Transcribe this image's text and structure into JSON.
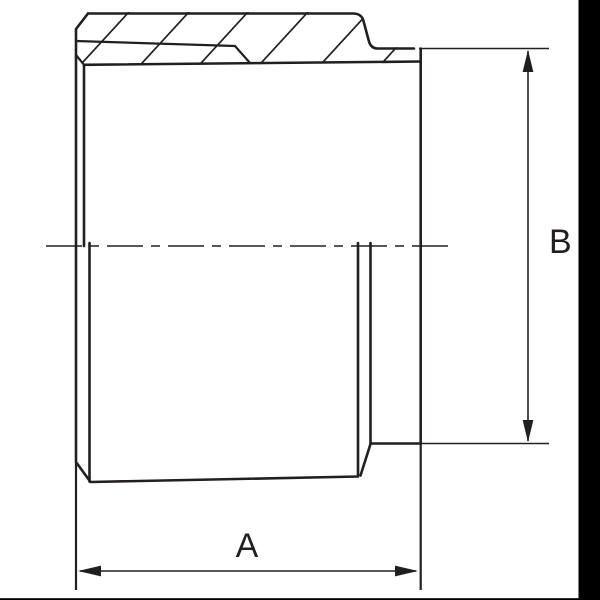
{
  "drawing": {
    "labels": {
      "dim_a": "A",
      "dim_b": "B"
    },
    "colors": {
      "line": "#231f20",
      "background": "#ffffff",
      "screen_edge": "#000000"
    }
  }
}
